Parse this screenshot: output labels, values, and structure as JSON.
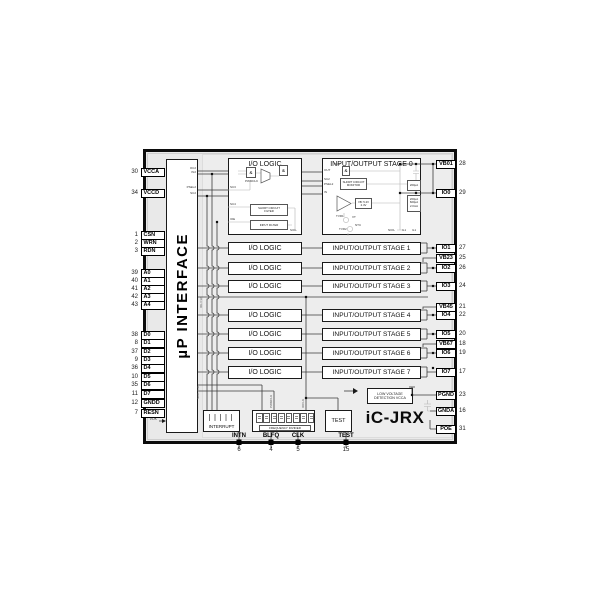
{
  "labels": {
    "chip_name": "iC-JRX",
    "interface": "µP INTERFACE",
    "io_logic": "I/O LOGIC",
    "interrupt": "INTERRUPT",
    "test": "TEST",
    "frequency_divider": "FREQUENCY DIVIDER",
    "low_voltage_line1": "LOW VOLTAGE",
    "low_voltage_line2": "DETECTION VCCA"
  },
  "stages": [
    "INPUT/OUTPUT STAGE 0",
    "INPUT/OUTPUT STAGE 1",
    "INPUT/OUTPUT STAGE 2",
    "INPUT/OUTPUT STAGE 3",
    "INPUT/OUTPUT STAGE 4",
    "INPUT/OUTPUT STAGE 5",
    "INPUT/OUTPUT STAGE 6",
    "INPUT/OUTPUT STAGE 7"
  ],
  "left_pins": [
    {
      "num": "30",
      "label": "VCCA"
    },
    {
      "num": "34",
      "label": "VCCD"
    },
    {
      "num": "1",
      "label": "CSN"
    },
    {
      "num": "2",
      "label": "WRN"
    },
    {
      "num": "3",
      "label": "RDN"
    },
    {
      "num": "39",
      "label": "A0"
    },
    {
      "num": "40",
      "label": "A1"
    },
    {
      "num": "41",
      "label": "A2"
    },
    {
      "num": "42",
      "label": "A3"
    },
    {
      "num": "43",
      "label": "A4"
    },
    {
      "num": "38",
      "label": "D0"
    },
    {
      "num": "8",
      "label": "D1"
    },
    {
      "num": "37",
      "label": "D2"
    },
    {
      "num": "9",
      "label": "D3"
    },
    {
      "num": "36",
      "label": "D4"
    },
    {
      "num": "10",
      "label": "D5"
    },
    {
      "num": "35",
      "label": "D6"
    },
    {
      "num": "11",
      "label": "D7"
    },
    {
      "num": "12",
      "label": "GNDD"
    },
    {
      "num": "7",
      "label": "RESN"
    }
  ],
  "right_pins": [
    {
      "num": "28",
      "label": "VB01"
    },
    {
      "num": "29",
      "label": "IO0"
    },
    {
      "num": "27",
      "label": "IO1"
    },
    {
      "num": "25",
      "label": "VB23"
    },
    {
      "num": "26",
      "label": "IO2"
    },
    {
      "num": "24",
      "label": "IO3"
    },
    {
      "num": "21",
      "label": "VB45"
    },
    {
      "num": "22",
      "label": "IO4"
    },
    {
      "num": "20",
      "label": "IO5"
    },
    {
      "num": "18",
      "label": "VB67"
    },
    {
      "num": "19",
      "label": "IO6"
    },
    {
      "num": "17",
      "label": "IO7"
    },
    {
      "num": "23",
      "label": "PGND"
    },
    {
      "num": "16",
      "label": "GNDA"
    },
    {
      "num": "31",
      "label": "POE"
    }
  ],
  "bottom_pins": [
    {
      "num": "6",
      "label": "INTN"
    },
    {
      "num": "4",
      "label": "BLFQ"
    },
    {
      "num": "5",
      "label": "CLK"
    },
    {
      "num": "15",
      "label": "TEST"
    }
  ],
  "logic_detail": {
    "and": "&",
    "pwmclk": "PWMCLK",
    "oc2": "OC2",
    "in2": "IN2",
    "psel2": "PSEL2",
    "sc2": "SC2",
    "sc3": "SC3",
    "sc4": "SC4",
    "ioe": "IOE",
    "filter1_line1": "SHORT CIRCUIT",
    "filter1_line2": "FILTER",
    "filter2": "INPUT FILTER",
    "siol": "SIOL"
  },
  "stage_detail": {
    "out": "OUT",
    "sc2": "SC2",
    "psel2": "PSEL2",
    "in": "IN",
    "pck": "PCK",
    "and": "&",
    "monitor_line1": "SHORT CIRCUIT",
    "monitor_line2": "MONITOR",
    "vb_line1": "VB: 5.2V",
    "vb_line2": "2.4V",
    "tvr1": "TVR1",
    "tvr2": "TVR2",
    "vt": "VT",
    "ntc": "NTC",
    "cur1": "200µA",
    "cur2a": "200µA",
    "cur2b": "600µA",
    "cur2c": "2.0mA",
    "niol": "NIOL",
    "il1": "IL1",
    "il2": "IL1"
  },
  "signals": {
    "vok": "VOK",
    "pwmclk": "PWMCLK",
    "ioclk": "IOCLK",
    "bus_a": "IOL CLK",
    "bus_b": "NOK T1R"
  }
}
